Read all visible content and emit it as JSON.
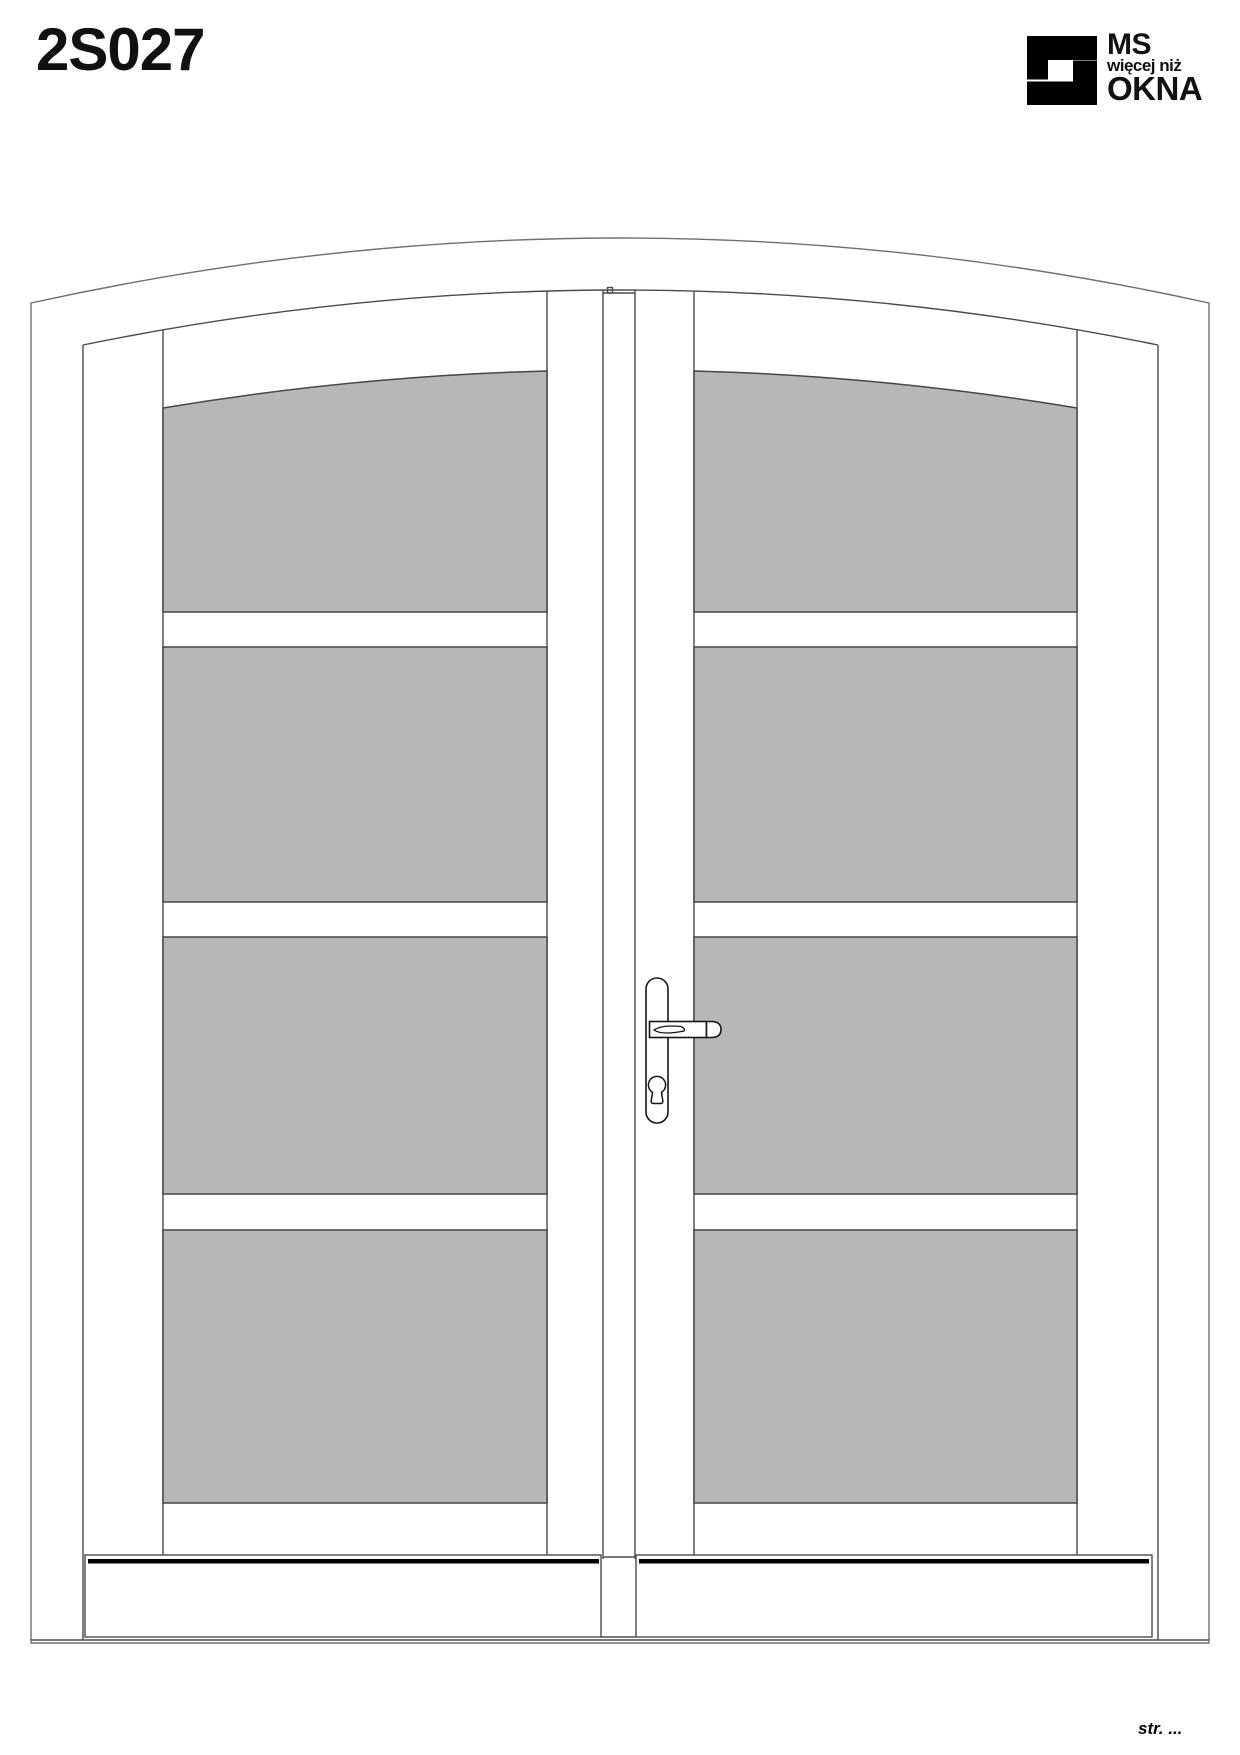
{
  "page": {
    "title": "2S027",
    "footer_page_label": "str. ..."
  },
  "logo": {
    "line1": "MS",
    "line2": "więcej niż",
    "line3": "OKNA"
  },
  "drawing": {
    "type": "arched double entrance door, front elevation",
    "leaves": 2,
    "glass_panels_per_leaf": 4,
    "glass_color": "#b7b7b7",
    "line_color": "#4b4b4b",
    "handle": "lever handle with euro-cylinder escutcheon on right leaf meeting stile"
  }
}
